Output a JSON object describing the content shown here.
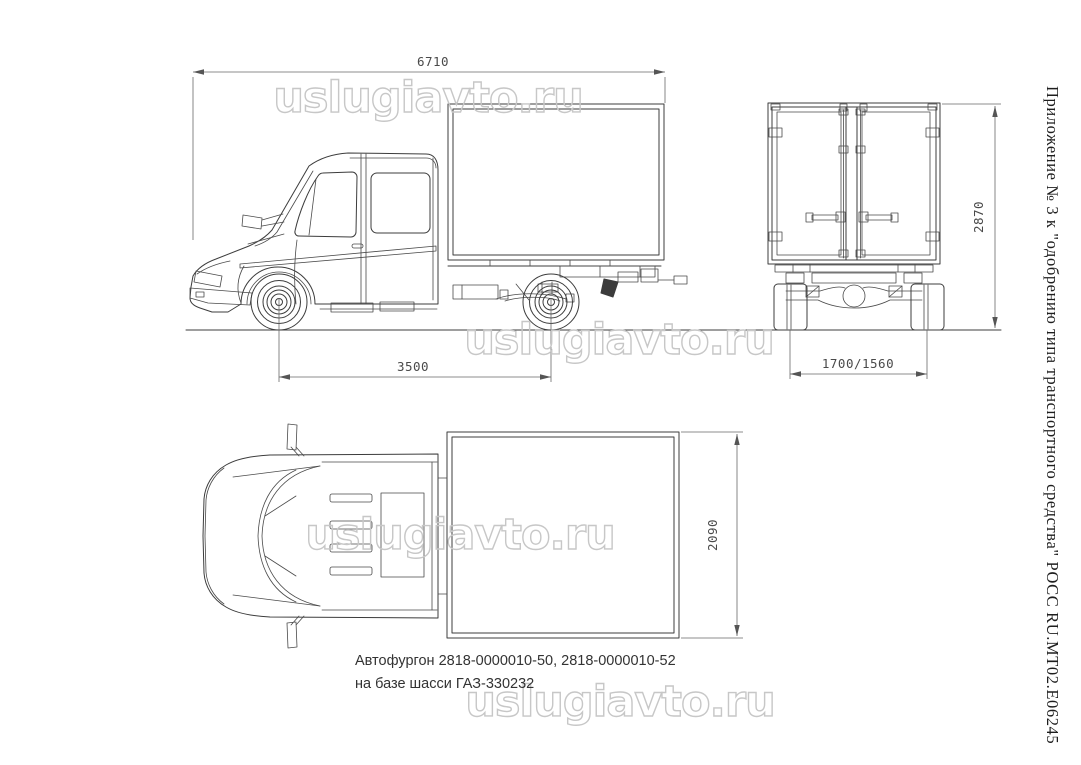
{
  "drawing": {
    "caption": {
      "line1": "Автофургон 2818-0000010-50, 2818-0000010-52",
      "line2": "на базе шасси ГАЗ-330232"
    },
    "side_note": "Приложение № 3 к \"одобрению типа транспортного средства\" РОСС RU.МТ02.Е06245",
    "views": {
      "side": {
        "label": "side view",
        "dim_overall_length": "6710",
        "dim_wheelbase": "3500"
      },
      "rear": {
        "label": "rear view",
        "dim_overall_height": "2870",
        "dim_track": "1700/1560"
      },
      "top": {
        "label": "top view",
        "dim_body_width": "2090"
      }
    },
    "line_color": "#3c3c3c",
    "dim_color": "#4a4a4a"
  },
  "watermark": {
    "text": "uslugiavto.ru",
    "color": "#c7c7c7"
  }
}
